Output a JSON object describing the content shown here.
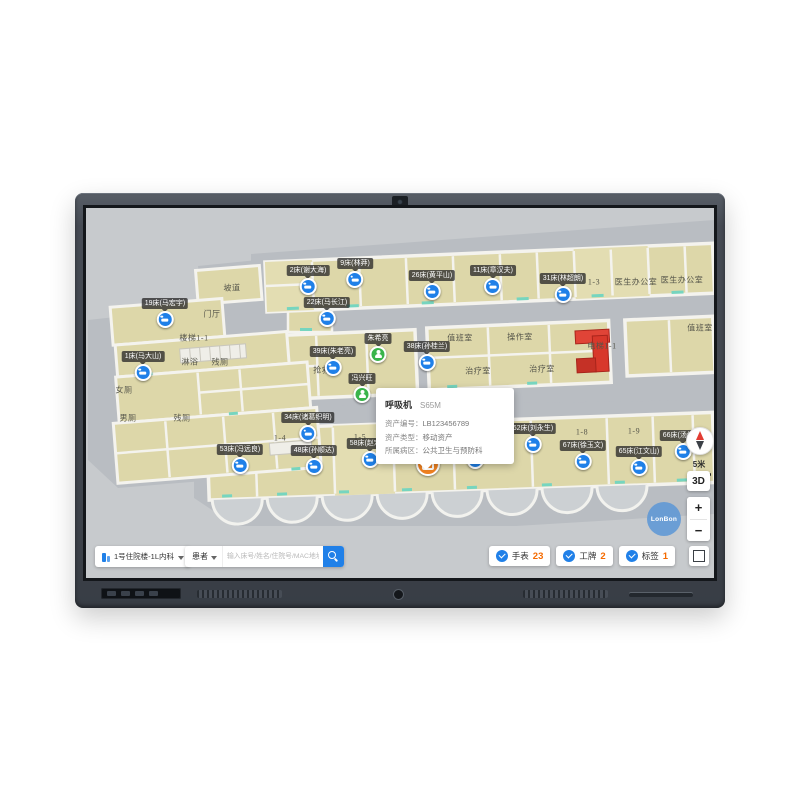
{
  "app": {
    "toolbar": {
      "building_selector": "1号住院楼-1L内科",
      "patient_filter": "患者",
      "search_placeholder": "输入床号/姓名/住院号/MAC地址"
    },
    "counters": [
      {
        "label": "手表",
        "count": "23"
      },
      {
        "label": "工牌",
        "count": "2"
      },
      {
        "label": "标签",
        "count": "1"
      }
    ],
    "controls": {
      "scale_label": "5米",
      "mode_3d": "3D",
      "zoom_in": "+",
      "zoom_out": "−"
    },
    "watermark": "LonBon",
    "tooltip": {
      "title": "呼吸机",
      "model": "S65M",
      "rows": [
        {
          "label": "资产编号：",
          "value": "LB123456789"
        },
        {
          "label": "资产类型：",
          "value": "移动资产"
        },
        {
          "label": "所属病区：",
          "value": "公共卫生与预防科"
        }
      ]
    },
    "map": {
      "rooms": [
        {
          "name": "坡道"
        },
        {
          "name": "门厅"
        },
        {
          "name": "楼梯1-1"
        },
        {
          "name": "淋浴"
        },
        {
          "name": "残厕"
        },
        {
          "name": "女厕"
        },
        {
          "name": "男厕"
        },
        {
          "name": "残厕"
        },
        {
          "name": "抢救室"
        },
        {
          "name": "值班室"
        },
        {
          "name": "操作室"
        },
        {
          "name": "治疗室"
        },
        {
          "name": "治疗室"
        },
        {
          "name": "1-3"
        },
        {
          "name": "医生办公室"
        },
        {
          "name": "医生办公室"
        },
        {
          "name": "值班室"
        },
        {
          "name": "电梯1-1"
        },
        {
          "name": "1-4"
        },
        {
          "name": "1-5"
        },
        {
          "name": "1-7"
        },
        {
          "name": "1-8"
        },
        {
          "name": "1-9"
        }
      ],
      "beds": [
        {
          "label": "19床(马宏宇)"
        },
        {
          "label": "1床(马大山)"
        },
        {
          "label": "2床(谢大海)"
        },
        {
          "label": "9床(林莽)"
        },
        {
          "label": "22床(马长江)"
        },
        {
          "label": "26床(黄平山)"
        },
        {
          "label": "11床(章汉夫)"
        },
        {
          "label": "31床(林超朗)"
        },
        {
          "label": "39床(朱老亮)"
        },
        {
          "label": "38床(孙桂兰)"
        },
        {
          "label": "34床(诸葛织明)"
        },
        {
          "label": "53床(冯远良)"
        },
        {
          "label": "48床(孙顺达)"
        },
        {
          "label": "58床(赵宏京)"
        },
        {
          "label": "60床(吕文达)"
        },
        {
          "label": "62床(刘永生)"
        },
        {
          "label": "67床(徐玉文)"
        },
        {
          "label": "65床(江文山)"
        },
        {
          "label": "66床(汤绍箕)"
        }
      ],
      "persons": [
        {
          "label": "朱希亮"
        },
        {
          "label": "冯兴旺"
        }
      ]
    },
    "colors": {
      "accent_blue": "#2080e8",
      "count_orange": "#f56a00",
      "marker_green": "#39b44a",
      "asset_orange": "#f08221",
      "elevator_red": "#d8382b",
      "room_fill": "#ddd7a9",
      "teal_accent": "#76d5bf"
    }
  }
}
